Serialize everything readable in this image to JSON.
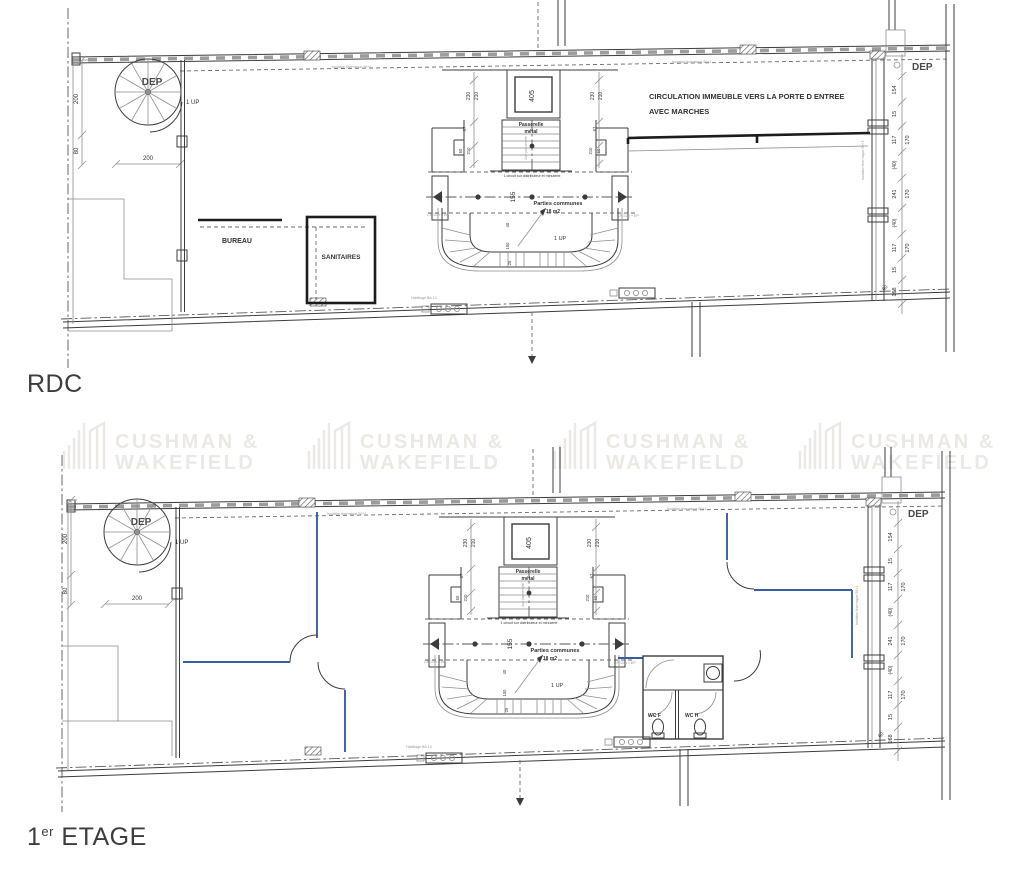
{
  "watermark": {
    "line1": "CUSHMAN &",
    "line2": "WAKEFIELD",
    "color": "#ece9e4"
  },
  "titles": {
    "rdc": "RDC",
    "etage_num": "1",
    "etage_sup": "er",
    "etage_rest": " ETAGE"
  },
  "labels": {
    "dep": "DEP",
    "up": "1 UP",
    "bureau": "BUREAU",
    "sanitaires": "SANITAIRES",
    "circulation1": "CIRCULATION IMMEUBLE VERS LA PORTE D ENTREE",
    "circulation2": "AVEC MARCHES",
    "passerelle1": "Passerelle",
    "passerelle2": "métal",
    "axe": "Axe passerelle",
    "circuit": "1 circuit sur distributeur et minuterie",
    "parties1": "Parties communes",
    "parties2": "18 m2",
    "cf_ep": "CF 1/2h + EP",
    "isolation": "Isolation thermique 50+1",
    "habillage": "Habillage BA 13",
    "wc_f": "WC F",
    "wc_h": "WC H"
  },
  "dims": {
    "w200": "200",
    "w80": "80",
    "shaft": "405",
    "v230": "230",
    "v210": "210",
    "v67": "67",
    "v60": "60",
    "v155": "155",
    "v40": "40",
    "v100": "100",
    "v25": "25",
    "c154": "154",
    "c15": "15",
    "c117": "117",
    "c170": "170",
    "c40": "(40)",
    "c241": "241",
    "c168": "168",
    "c60": "60"
  }
}
